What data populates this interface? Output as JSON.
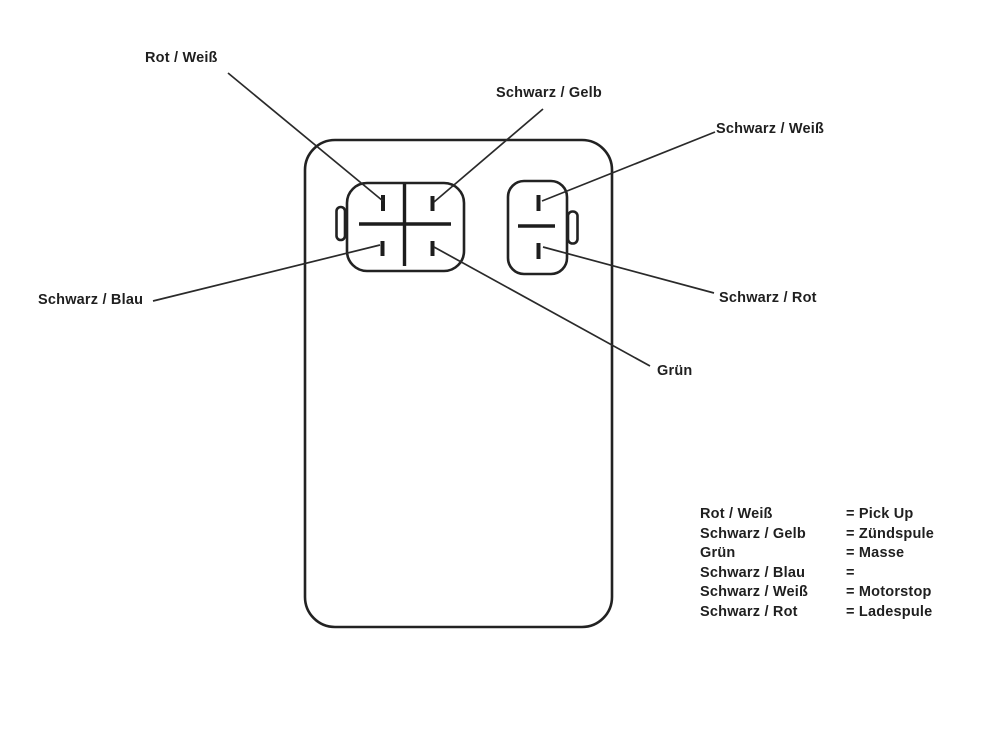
{
  "colors": {
    "ink": "#1f1f1f",
    "background": "#ffffff"
  },
  "callouts": [
    {
      "id": "rot-weiss",
      "label": "Rot / Weiß"
    },
    {
      "id": "schwarz-gelb",
      "label": "Schwarz / Gelb"
    },
    {
      "id": "schwarz-weiss",
      "label": "Schwarz / Weiß"
    },
    {
      "id": "schwarz-blau",
      "label": "Schwarz / Blau"
    },
    {
      "id": "schwarz-rot",
      "label": "Schwarz / Rot"
    },
    {
      "id": "gruen",
      "label": "Grün"
    }
  ],
  "connectors": {
    "left": {
      "pins": 4
    },
    "right": {
      "pins": 2
    }
  },
  "legend": {
    "rows": [
      {
        "wire": "Rot / Weiß",
        "value": "= Pick Up"
      },
      {
        "wire": "Schwarz / Gelb",
        "value": "= Zündspule"
      },
      {
        "wire": "Grün",
        "value": "= Masse"
      },
      {
        "wire": "Schwarz / Blau",
        "value": "="
      },
      {
        "wire": "Schwarz / Weiß",
        "value": "= Motorstop"
      },
      {
        "wire": "Schwarz / Rot",
        "value": "= Ladespule"
      }
    ]
  }
}
